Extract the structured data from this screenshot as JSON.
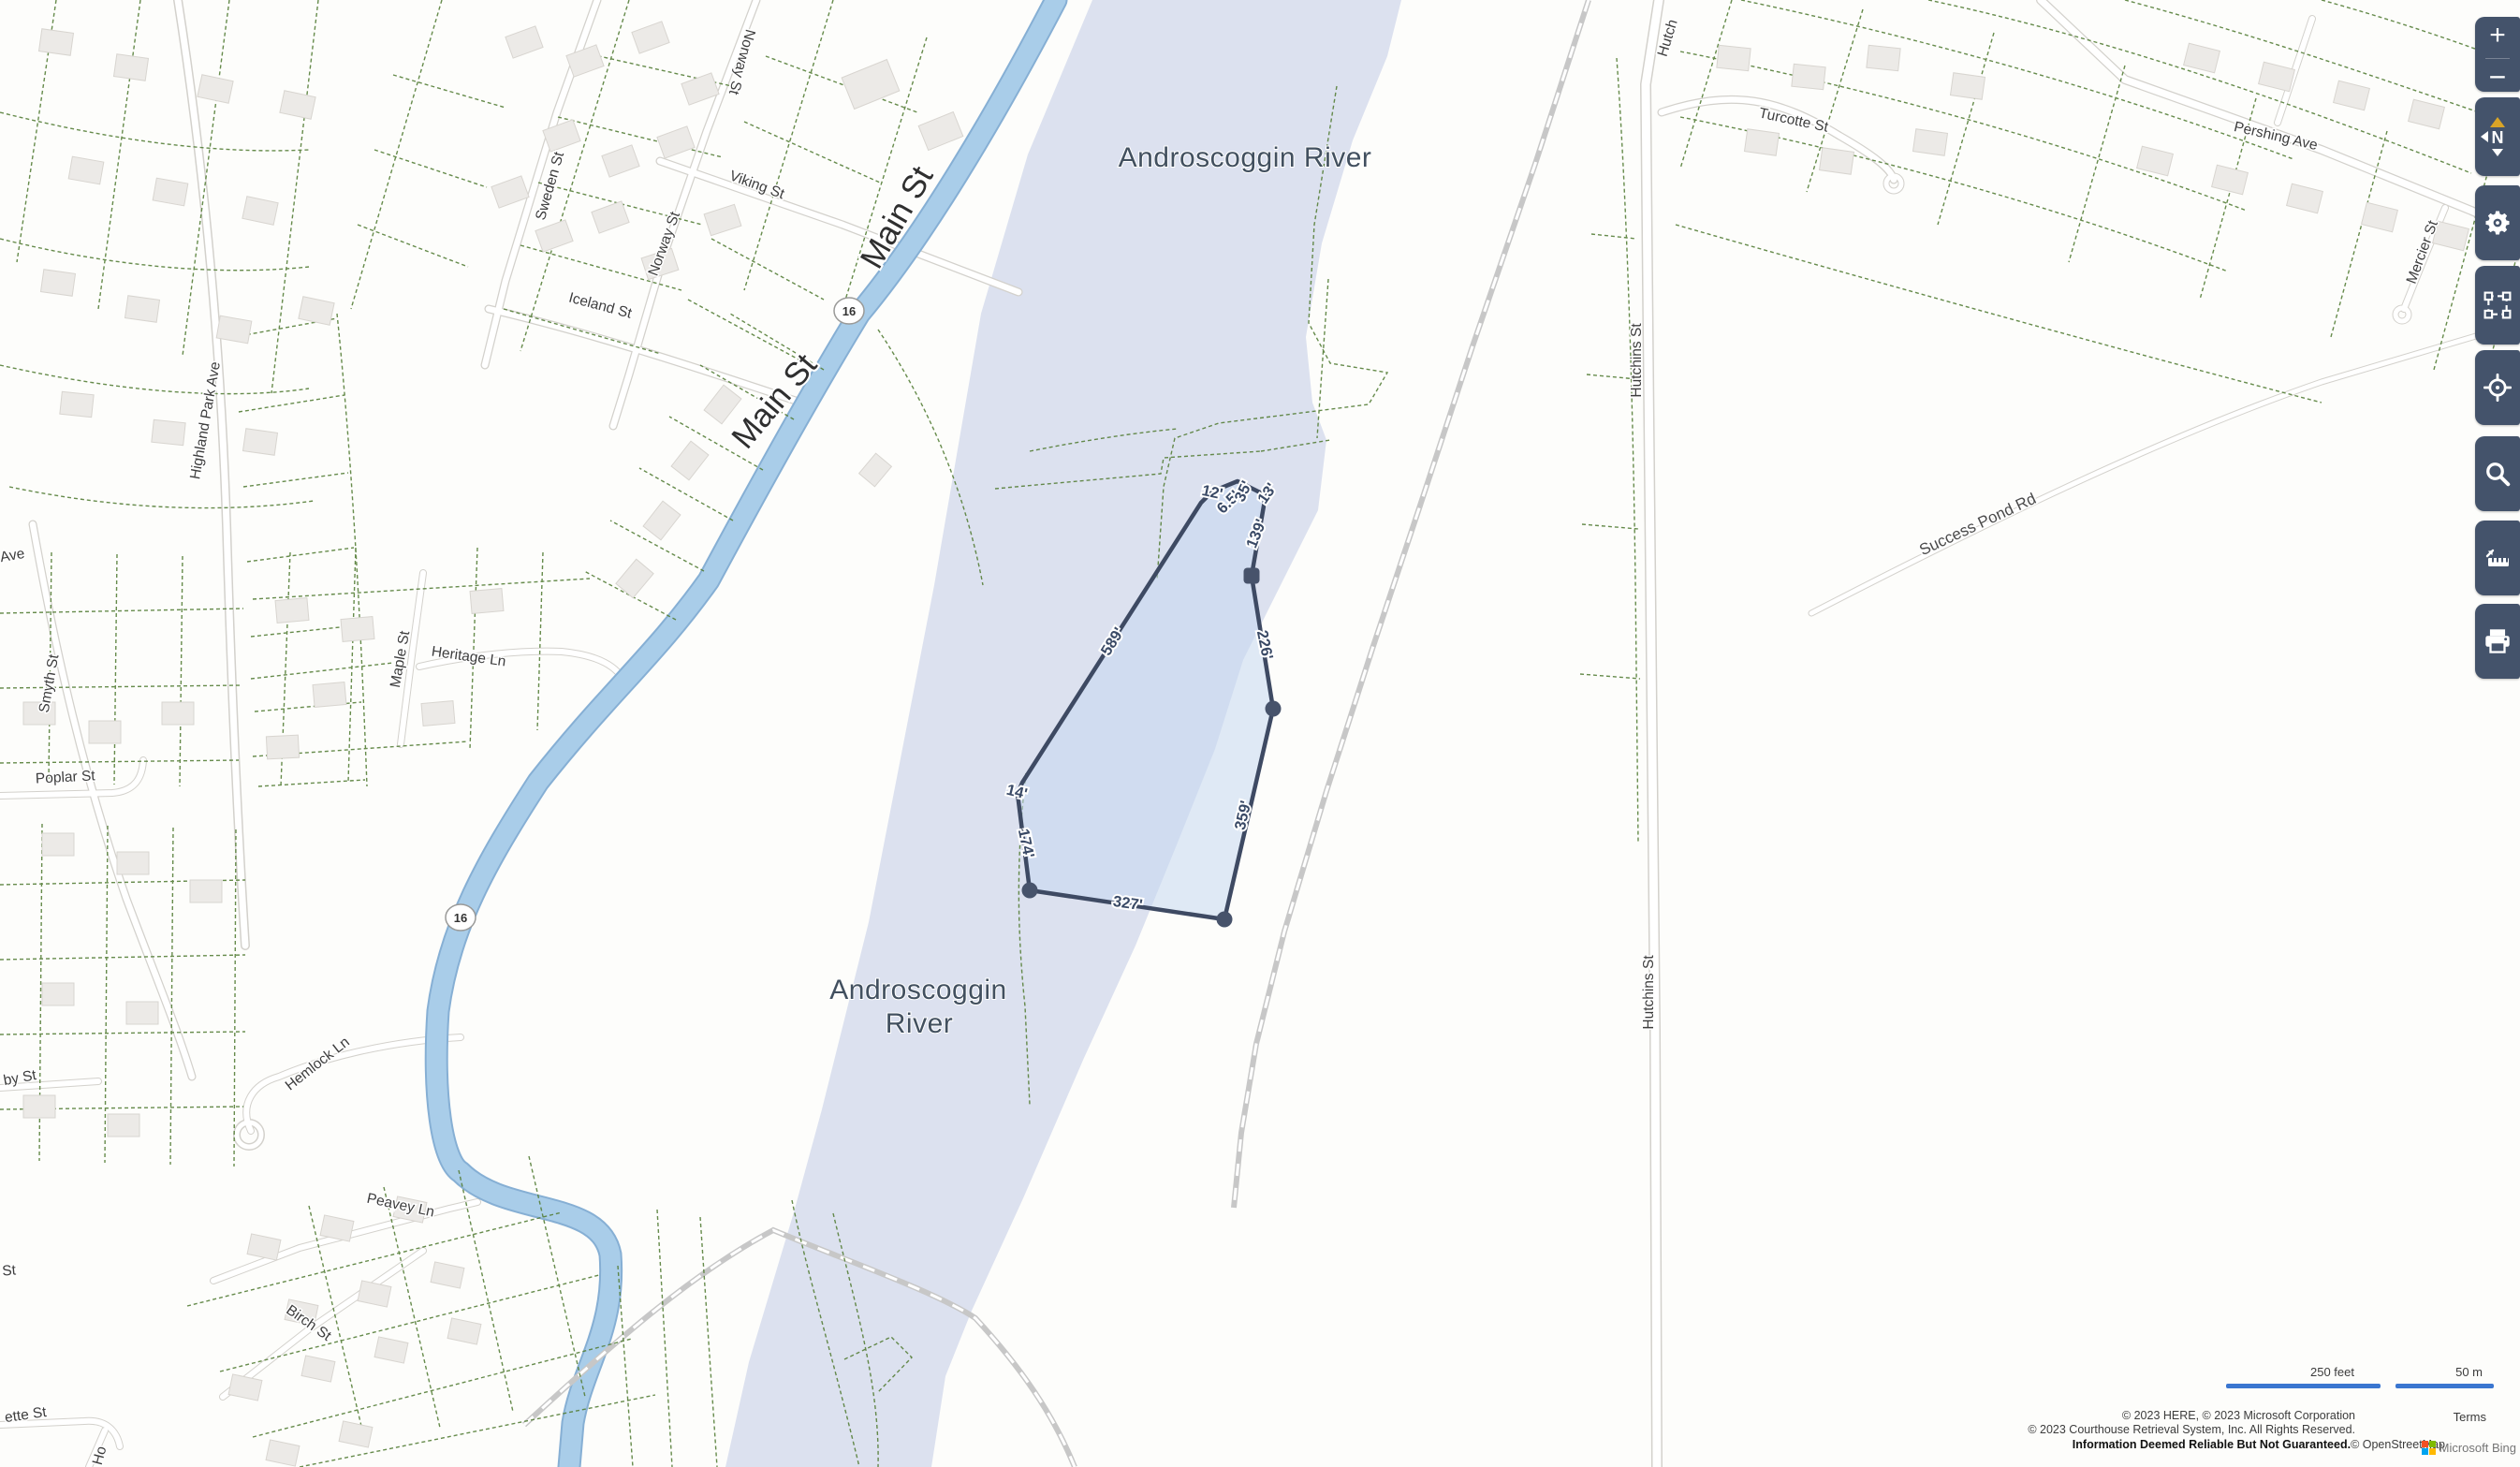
{
  "map": {
    "water_label": "Androscoggin River",
    "water_label_wrapped": {
      "line1": "Androscoggin",
      "line2": "River"
    },
    "route_shield": "16",
    "streets": {
      "norway_st_1": "Norway St",
      "norway_st_2": "Norway St",
      "viking_st": "Viking St",
      "sweden_st": "Sweden St",
      "iceland_st": "Iceland St",
      "main_st_1": "Main St",
      "main_st_2": "Main St",
      "highland_park_ave": "Highland Park Ave",
      "ave_fragment": "Ave",
      "smyth_st": "Smyth St",
      "maple_st": "Maple St",
      "heritage_ln": "Heritage Ln",
      "poplar_st": "Poplar St",
      "by_st_fragment": "by St",
      "st_fragment": "St",
      "ette_st_fragment": "ette St",
      "ho_fragment": "Ho",
      "hemlock_ln": "Hemlock Ln",
      "peavey_ln": "Peavey Ln",
      "birch_st": "Birch St",
      "hutch_fragment": "Hutch",
      "hutchins_st_1": "Hutchins St",
      "hutchins_st_2": "Hutchins St",
      "turcotte_st": "Turcotte St",
      "pershing_ave": "Pershing Ave",
      "mercier_st": "Mercier St",
      "success_pond_rd": "Success Pond Rd"
    }
  },
  "measurements": {
    "seg_12": "12'",
    "seg_6_5": "6.5'",
    "seg_35": "35'",
    "seg_13": "13'",
    "seg_139": "139'",
    "seg_226": "226'",
    "seg_359": "359'",
    "seg_327": "327'",
    "seg_174": "174'",
    "seg_14": "14'",
    "seg_589": "589'"
  },
  "toolbar": {
    "zoom_in": "+",
    "zoom_out": "−",
    "compass_north": "N",
    "buttons": [
      {
        "name": "zoom-in",
        "icon": "plus-icon"
      },
      {
        "name": "zoom-out",
        "icon": "minus-icon"
      },
      {
        "name": "compass",
        "icon": "compass-north-icon"
      },
      {
        "name": "settings",
        "icon": "gear-icon"
      },
      {
        "name": "select-area",
        "icon": "marquee-icon"
      },
      {
        "name": "locate",
        "icon": "crosshair-icon"
      },
      {
        "name": "search",
        "icon": "search-icon"
      },
      {
        "name": "measure",
        "icon": "ruler-icon"
      },
      {
        "name": "print",
        "icon": "printer-icon"
      }
    ]
  },
  "scale_bar": {
    "imperial": "250 feet",
    "metric": "50 m"
  },
  "attribution": {
    "line1": "© 2023 HERE, © 2023 Microsoft Corporation",
    "line2": "© 2023 Courthouse Retrieval System, Inc. All Rights Reserved.",
    "line3_bold": "Information Deemed Reliable But Not Guaranteed.",
    "line3_osm": "© OpenStreetMap",
    "bing_brand": "Microsoft Bing",
    "terms": "Terms"
  },
  "colors": {
    "toolbar_bg": "#44536b",
    "compass_arrow": "#d9a427",
    "measure_stroke": "#3e4a63",
    "measure_fill": "#c7d8f1",
    "parcel_line": "#567f39",
    "water": "#dce1ef",
    "main_st_road": "#a9cde9",
    "scale_bar_blue": "#3a76d0",
    "ms_logo": [
      "#f25022",
      "#7fba00",
      "#00a4ef",
      "#ffb900"
    ]
  }
}
